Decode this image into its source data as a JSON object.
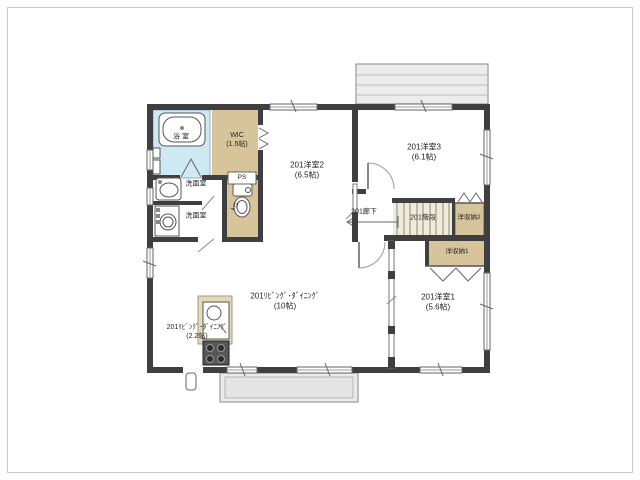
{
  "page": {
    "background": "#ffffff",
    "type": "floor-plan",
    "unit_number": "201"
  },
  "colors": {
    "wall": "#3f3f3f",
    "closet_tan": "#d8c49a",
    "bath_blue": "#cde9f4",
    "stairs_cream": "#f0ead8",
    "kitchen_counter": "#e6d9b8",
    "balcony_gray": "#eaeaea",
    "line_gray": "#666666",
    "text": "#1f1f1f"
  },
  "rooms": {
    "bath": {
      "label": "浴室"
    },
    "wic": {
      "label": "WIC",
      "size": "(1.5帖)"
    },
    "washroom_upper": {
      "label": "洗面室"
    },
    "washroom_lower": {
      "label": "洗面室"
    },
    "pipe_space": {
      "label": "PS"
    },
    "toilet": {
      "label": "ﾄｲﾚ"
    },
    "bedroom2": {
      "label": "201洋室2",
      "size": "(6.5帖)"
    },
    "bedroom3": {
      "label": "201洋室3",
      "size": "(6.1帖)"
    },
    "hallway": {
      "label": "201廊下"
    },
    "stairs": {
      "label": "201階段"
    },
    "closet2": {
      "label": "洋収納2"
    },
    "closet1": {
      "label": "洋収納1"
    },
    "bedroom1": {
      "label": "201洋室1",
      "size": "(5.6帖)"
    },
    "living_dining": {
      "label": "201ﾘﾋﾞﾝｸﾞ･ﾀﾞｲﾆﾝｸﾞ",
      "size": "(10帖)"
    },
    "kitchen": {
      "label": "201ﾘﾋﾞﾝｸﾞ･ﾀﾞｲﾆﾝｸﾞ",
      "size": "(2.2帖)"
    }
  },
  "icons": [
    "bathtub-icon",
    "washbasin-icon",
    "washing-machine-icon",
    "toilet-icon",
    "kitchen-sink-icon",
    "stove-icon",
    "stairs-treads",
    "door-arc",
    "window",
    "balcony"
  ]
}
